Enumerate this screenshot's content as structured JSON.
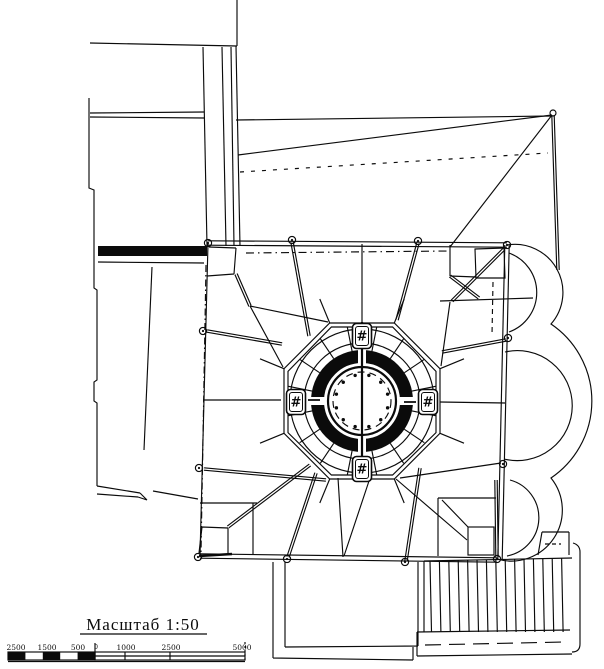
{
  "drawing": {
    "scale_label": "Масштаб 1:50",
    "scale_bar_labels": [
      "2500",
      "1500",
      "500",
      "0",
      "1000",
      "2500",
      "5000"
    ],
    "dome_badges": [
      {
        "position": "north",
        "symbol": "#"
      },
      {
        "position": "east",
        "symbol": "#"
      },
      {
        "position": "south",
        "symbol": "#"
      },
      {
        "position": "west",
        "symbol": "#"
      }
    ],
    "colors": {
      "ink": "#0b0b0b",
      "paper": "#ffffff"
    }
  }
}
